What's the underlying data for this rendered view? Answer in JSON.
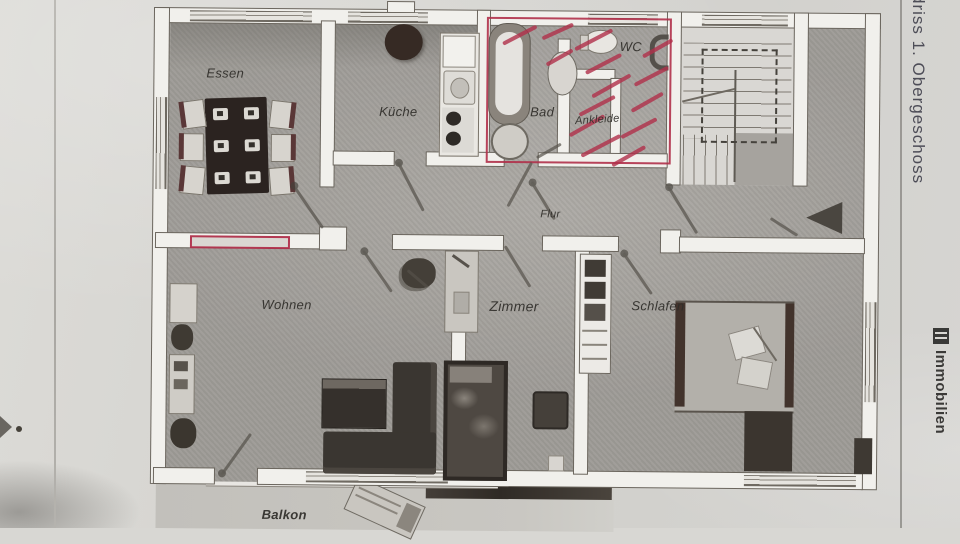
{
  "labels": {
    "essen": "Essen",
    "kueche": "Küche",
    "bad": "Bad",
    "wc": "WC",
    "ankleide": "Ankleide",
    "flur": "Flur",
    "wohnen": "Wohnen",
    "zimmer": "Zimmer",
    "schlafen": "Schlafen",
    "balkon": "Balkon"
  },
  "margin": {
    "title_vertical": "driss 1. Obergeschoss",
    "brand_vertical": "Immobilien"
  },
  "colors": {
    "paper": "#d8d7d3",
    "floor": "#a6a39e",
    "wall": "#f1f0ec",
    "wall_edge": "#6b665e",
    "red_marker": "#b0304a",
    "label_text": "#2f2d29",
    "margin_title_text": "#4d4d57",
    "brand_text": "#3b3a38"
  },
  "annotations": {
    "red_strokes": [
      {
        "x": 520,
        "y": 30,
        "len": 38,
        "a": -28
      },
      {
        "x": 558,
        "y": 26,
        "len": 34,
        "a": -25
      },
      {
        "x": 594,
        "y": 34,
        "len": 42,
        "a": -28
      },
      {
        "x": 560,
        "y": 52,
        "len": 30,
        "a": -30
      },
      {
        "x": 604,
        "y": 58,
        "len": 40,
        "a": -28
      },
      {
        "x": 612,
        "y": 80,
        "len": 44,
        "a": -30
      },
      {
        "x": 598,
        "y": 100,
        "len": 40,
        "a": -28
      },
      {
        "x": 588,
        "y": 120,
        "len": 40,
        "a": -30
      },
      {
        "x": 602,
        "y": 140,
        "len": 44,
        "a": -28
      },
      {
        "x": 630,
        "y": 150,
        "len": 38,
        "a": -30
      },
      {
        "x": 640,
        "y": 122,
        "len": 40,
        "a": -28
      },
      {
        "x": 648,
        "y": 96,
        "len": 36,
        "a": -30
      },
      {
        "x": 652,
        "y": 70,
        "len": 38,
        "a": -28
      },
      {
        "x": 658,
        "y": 42,
        "len": 34,
        "a": -30
      }
    ],
    "door_swings": [
      {
        "x": 310,
        "y": 204,
        "len": 52,
        "a": 55,
        "dot": true
      },
      {
        "x": 412,
        "y": 183,
        "len": 55,
        "a": 62,
        "dot": true
      },
      {
        "x": 521,
        "y": 180,
        "len": 50,
        "a": -62,
        "dot": false
      },
      {
        "x": 545,
        "y": 196,
        "len": 44,
        "a": 58,
        "dot": true
      },
      {
        "x": 684,
        "y": 204,
        "len": 55,
        "a": 58,
        "dot": true
      },
      {
        "x": 786,
        "y": 220,
        "len": 32,
        "a": 32,
        "dot": false
      },
      {
        "x": 380,
        "y": 268,
        "len": 50,
        "a": 55,
        "dot": true
      },
      {
        "x": 520,
        "y": 262,
        "len": 48,
        "a": 58,
        "dot": false
      },
      {
        "x": 640,
        "y": 268,
        "len": 50,
        "a": 55,
        "dot": true
      },
      {
        "x": 240,
        "y": 452,
        "len": 50,
        "a": -55,
        "dot": true
      },
      {
        "x": 550,
        "y": 146,
        "len": 28,
        "a": -30,
        "dot": false
      },
      {
        "x": 420,
        "y": 275,
        "len": 26,
        "a": 40,
        "dot": false
      }
    ]
  }
}
